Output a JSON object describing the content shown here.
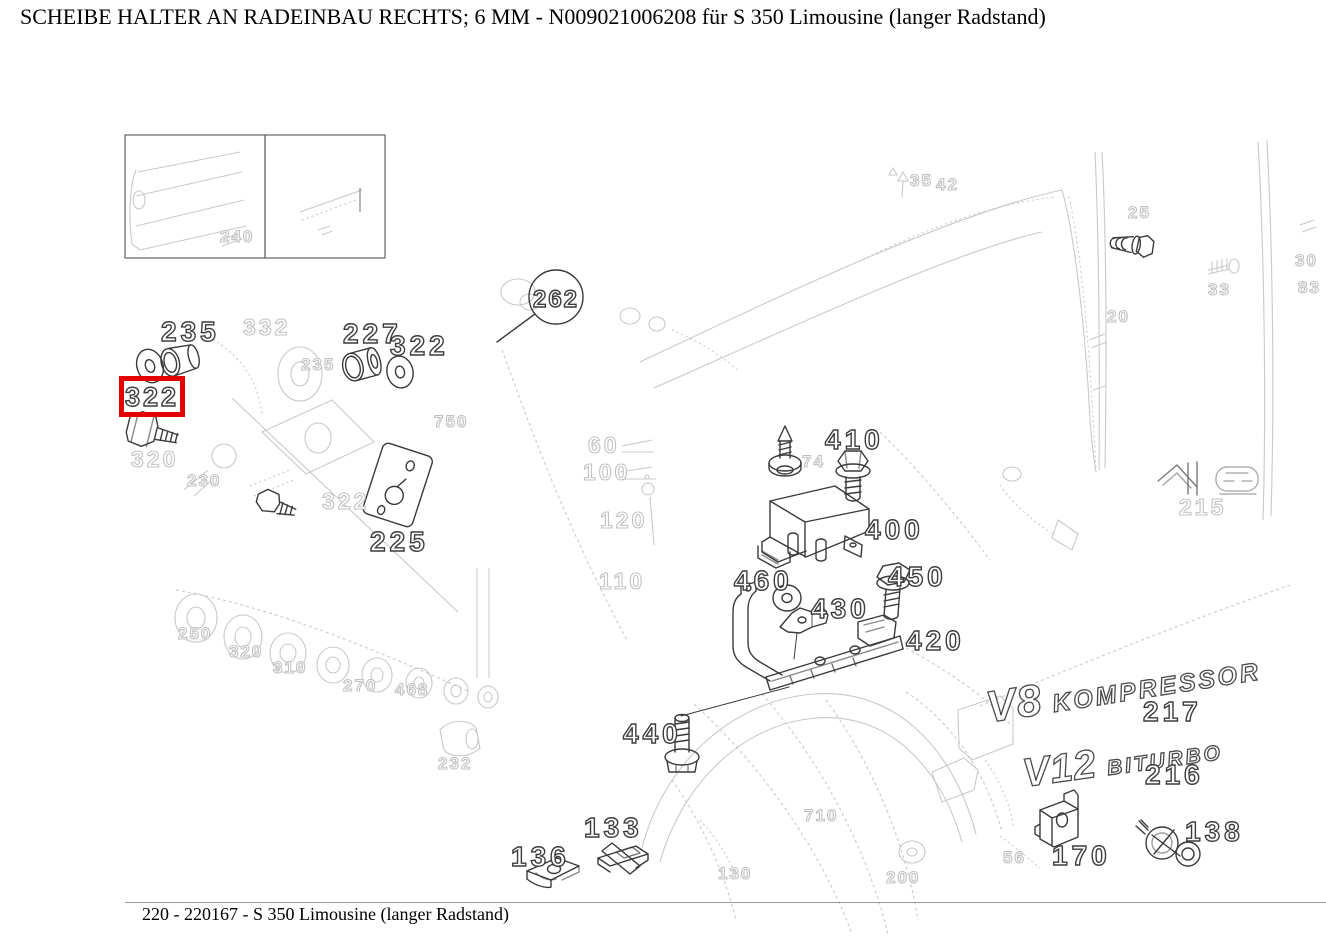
{
  "title": "SCHEIBE HALTER AN RADEINBAU RECHTS; 6 MM - N009021006208 für S 350 Limousine (langer Radstand)",
  "footer": "220 - 220167 - S 350 Limousine (langer Radstand)",
  "highlight": {
    "label": "322",
    "box_color": "#e40000"
  },
  "callout_circle": "262",
  "badges": {
    "v8_main": "V8",
    "v8_sub": "KOMPRESSOR",
    "v8_num": "217",
    "v12_main": "V12",
    "v12_sub": "BITURBO",
    "v12_num": "216"
  },
  "dark_labels": [
    {
      "text": "235"
    },
    {
      "text": "227"
    },
    {
      "text": "322"
    },
    {
      "text": "225"
    },
    {
      "text": "410"
    },
    {
      "text": "400"
    },
    {
      "text": "450"
    },
    {
      "text": "460"
    },
    {
      "text": "430"
    },
    {
      "text": "420"
    },
    {
      "text": "440"
    },
    {
      "text": "136"
    },
    {
      "text": "133"
    },
    {
      "text": "170"
    },
    {
      "text": "138"
    }
  ],
  "faint_labels": [
    {
      "text": "332"
    },
    {
      "text": "235"
    },
    {
      "text": "320"
    },
    {
      "text": "230"
    },
    {
      "text": "322"
    },
    {
      "text": "750"
    },
    {
      "text": "60"
    },
    {
      "text": "100"
    },
    {
      "text": "120"
    },
    {
      "text": "110"
    },
    {
      "text": "74"
    },
    {
      "text": "250"
    },
    {
      "text": "320"
    },
    {
      "text": "310"
    },
    {
      "text": "270"
    },
    {
      "text": "468"
    },
    {
      "text": "232"
    },
    {
      "text": "710"
    },
    {
      "text": "130"
    },
    {
      "text": "200"
    },
    {
      "text": "56"
    },
    {
      "text": "35"
    },
    {
      "text": "42"
    },
    {
      "text": "25"
    },
    {
      "text": "33"
    },
    {
      "text": "20"
    },
    {
      "text": "215"
    },
    {
      "text": "30"
    },
    {
      "text": "83"
    },
    {
      "text": "240"
    }
  ]
}
